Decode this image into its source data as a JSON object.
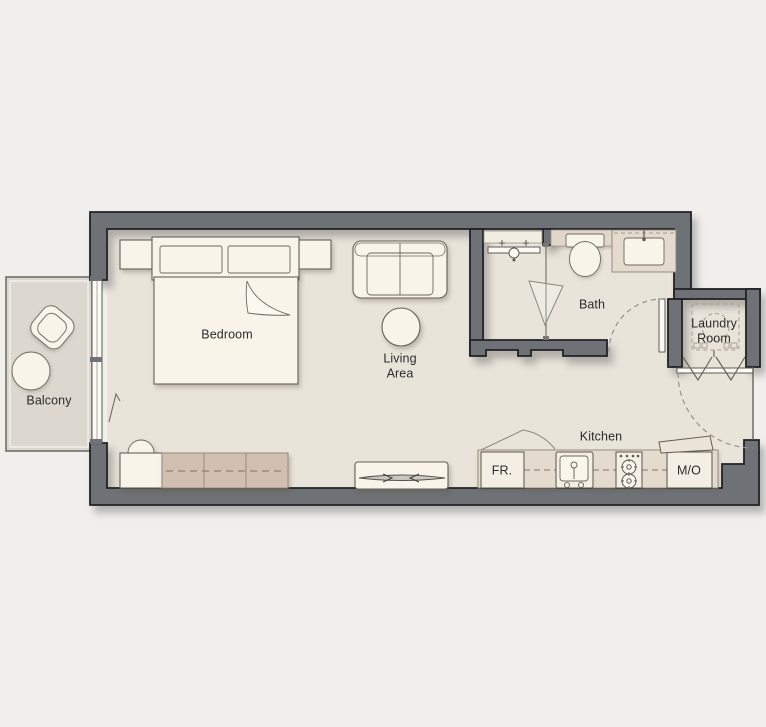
{
  "floorplan": {
    "type": "studio-apartment-floor-plan",
    "rooms": {
      "bedroom": "Bedroom",
      "living_area": "Living Area",
      "balcony": "Balcony",
      "bath": "Bath",
      "laundry_room": "Laundry Room",
      "kitchen": "Kitchen"
    },
    "appliances": {
      "fridge": "FR.",
      "microwave_oven": "M/O"
    },
    "colors": {
      "background": "#f0efec",
      "wall": "#6e7175",
      "wall_outline": "#222226",
      "floor": "#e9e4da",
      "balcony_floor": "#dcd8d0",
      "counter": "#e4dacd",
      "wardrobe": "#d1bfb1",
      "furniture": "#f8f4ea",
      "label_text": "#2c2c2c"
    },
    "furniture_icons": [
      "double-bed-icon",
      "headboard-icon",
      "pillow-icon",
      "nightstand-icon",
      "sofa-icon",
      "coffee-table-icon",
      "tv-console-icon",
      "tv-icon",
      "desk-icon",
      "chair-icon",
      "wardrobe-icon",
      "lounge-chair-icon",
      "round-table-icon",
      "sliding-window-icon",
      "toilet-icon",
      "vanity-sink-icon",
      "shower-icon",
      "shower-glass-icon",
      "washing-machine-icon",
      "bifold-door-icon",
      "door-swing-icon",
      "fridge-icon",
      "kitchen-sink-icon",
      "cooktop-icon",
      "microwave-icon"
    ]
  }
}
